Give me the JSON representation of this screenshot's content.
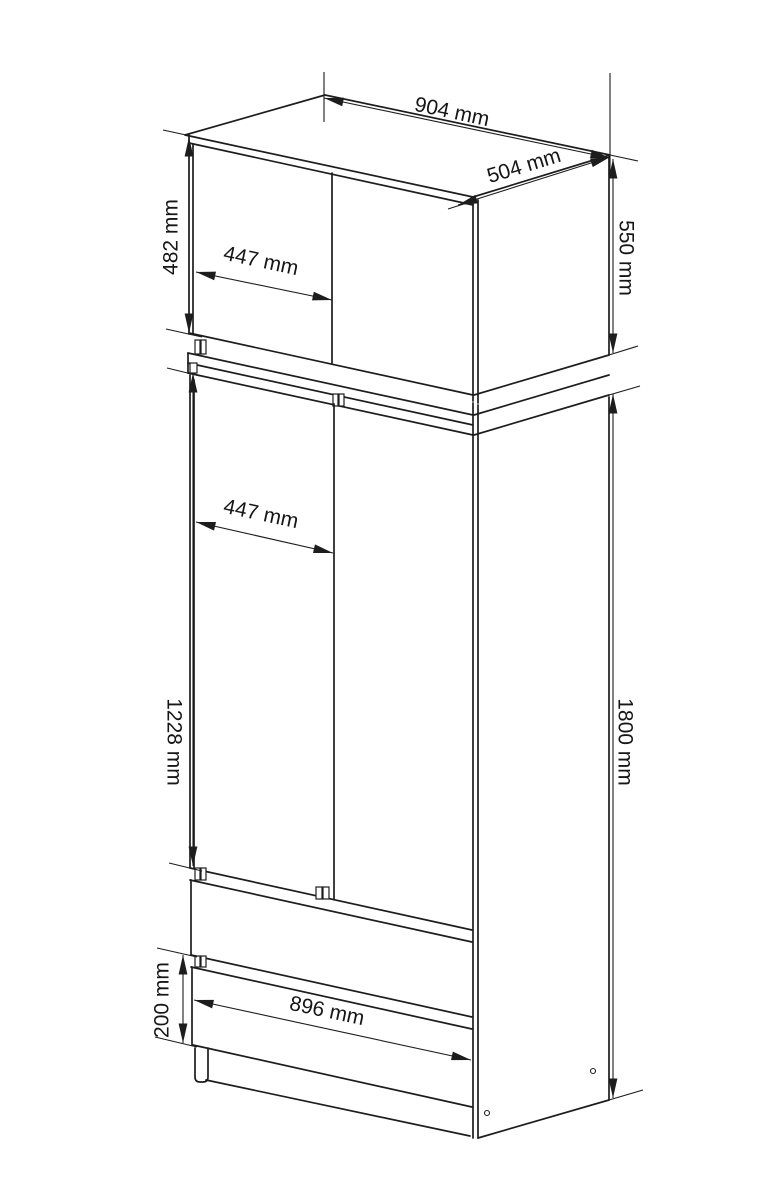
{
  "drawing": {
    "title": "Wardrobe technical dimension drawing",
    "subject": "Two-door wardrobe with top extension cabinet and two drawers, isometric view",
    "background_color": "#ffffff",
    "line_color": "#1d1d1d",
    "dimensions": {
      "top_width": "904 mm",
      "top_depth": "504 mm",
      "upper_door_height": "482 mm",
      "upper_door_width": "447 mm",
      "upper_cabinet_height": "550 mm",
      "main_door_width": "447 mm",
      "main_door_height": "1228 mm",
      "wardrobe_height": "1800 mm",
      "drawer_front_height": "200 mm",
      "drawer_width": "896 mm"
    }
  }
}
